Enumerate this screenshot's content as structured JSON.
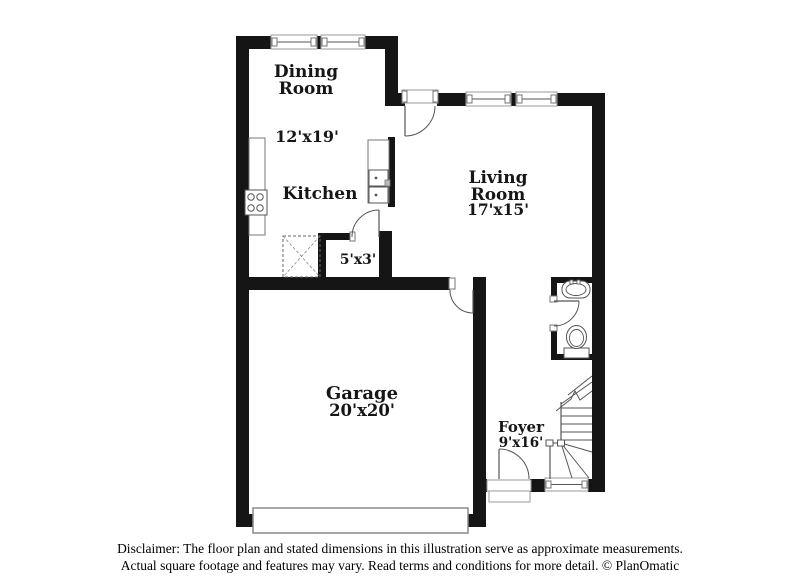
{
  "document_type": "floor-plan",
  "colors": {
    "wall": "#151515",
    "fixture_line": "#555555",
    "window_border": "#9a9a9a",
    "label_text": "#161616",
    "background": "#ffffff"
  },
  "rooms": {
    "dining": {
      "label_line1": "Dining",
      "label_line2": "Room",
      "dims": "12'x19'"
    },
    "kitchen": {
      "label": "Kitchen"
    },
    "living": {
      "label_line1": "Living",
      "label_line2": "Room",
      "dims": "17'x15'"
    },
    "closet": {
      "dims": "5'x3'"
    },
    "garage": {
      "label": "Garage",
      "dims": "20'x20'"
    },
    "foyer": {
      "label": "Foyer",
      "dims": "9'x16'"
    }
  },
  "disclaimer": {
    "line1": "Disclaimer: The floor plan and stated dimensions in this illustration serve as approximate measurements.",
    "line2": "Actual square footage and features may vary. Read terms and conditions for more detail. © PlanOmatic"
  }
}
